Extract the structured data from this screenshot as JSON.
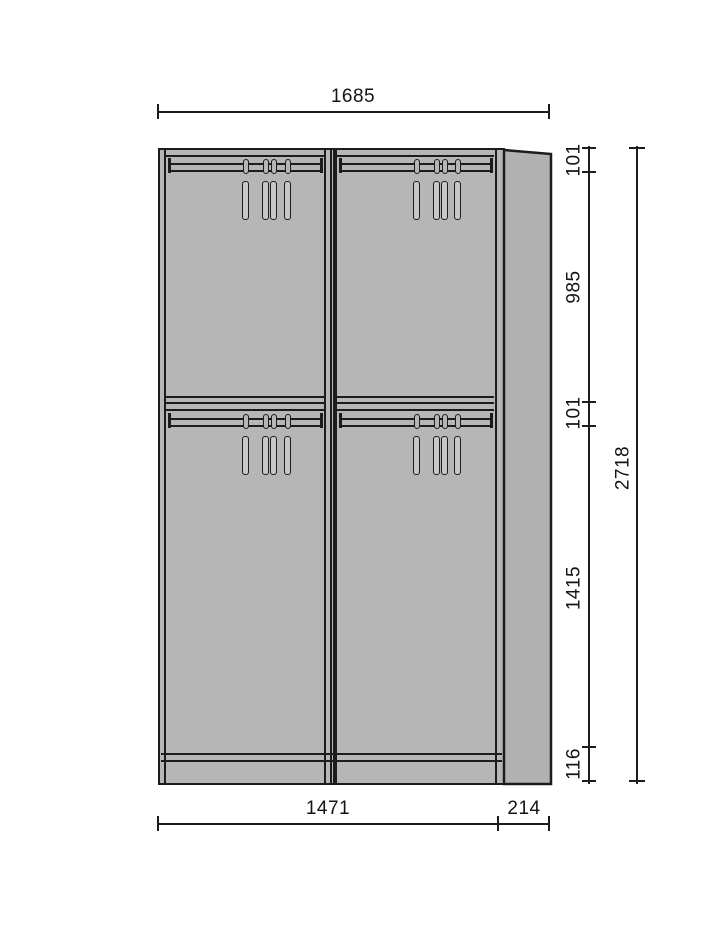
{
  "title": "Wardrobe elevation technical drawing",
  "dimensions": {
    "top_width": "1685",
    "overall_height": "2718",
    "bottom_main_width": "1471",
    "bottom_side_width": "214",
    "right_chain": [
      "101",
      "985",
      "101",
      "1415",
      "116"
    ]
  },
  "colors": {
    "line": "#1c1c1c",
    "text": "#141414",
    "bg": "#ffffff",
    "cabinet": "#b6b6b6",
    "side": "#b1b1b1",
    "hanger": "#c7c7c7"
  }
}
